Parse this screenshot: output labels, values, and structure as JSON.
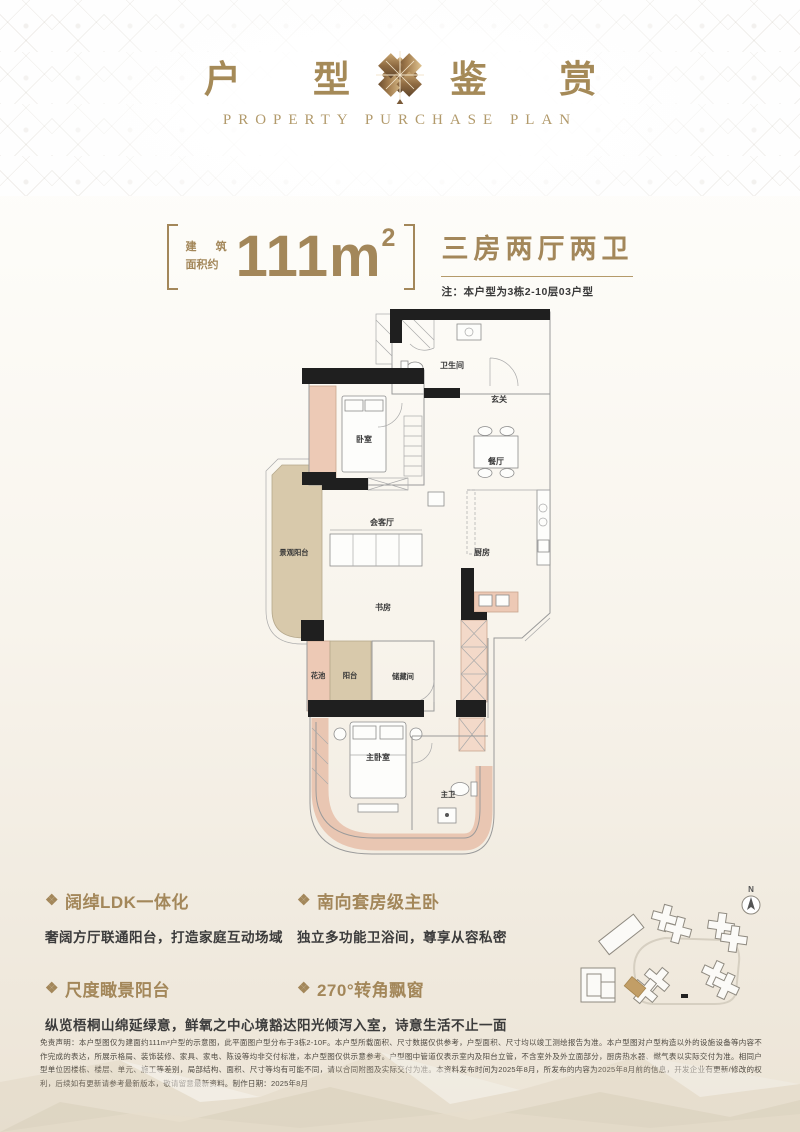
{
  "header": {
    "title_left": "户 型",
    "title_right": "鉴 赏",
    "subtitle": "PROPERTY PURCHASE PLAN"
  },
  "area": {
    "label_line1": "建 筑",
    "label_line2": "面积约",
    "value_number": "111m",
    "value_sup": "2",
    "layout_type": "三房两厅两卫",
    "note": "注：本户型为3栋2-10层03户型"
  },
  "floorplan": {
    "labels": {
      "bathroom": "卫生间",
      "foyer": "玄关",
      "dining": "餐厅",
      "bedroom": "卧室",
      "living": "会客厅",
      "view_balcony": "景观阳台",
      "kitchen": "厨房",
      "study": "书房",
      "flower_bed": "花池",
      "balcony": "阳台",
      "storage": "储藏间",
      "master_bedroom": "主卧室",
      "master_bath": "主卫"
    }
  },
  "features": [
    {
      "icon": "❖",
      "title": "阔绰LDK一体化",
      "desc": "奢阔方厅联通阳台，打造家庭互动场域"
    },
    {
      "icon": "❖",
      "title": "南向套房级主卧",
      "desc": "独立多功能卫浴间，尊享从容私密"
    },
    {
      "icon": "❖",
      "title": "尺度瞰景阳台",
      "desc": "纵览梧桐山绵延绿意，鲜氧之中心境豁达"
    },
    {
      "icon": "❖",
      "title": "270°转角飘窗",
      "desc": "阳光倾泻入室，诗意生活不止一面"
    }
  ],
  "siteplan": {
    "north_label": "N"
  },
  "disclaimer": "免责声明：本户型图仅为建面约111m²户型的示意图，此平面图户型分布于3栋2-10F。本户型所载面积、尺寸数据仅供参考，户型面积、尺寸均以竣工测绘报告为准。本户型图对户型构造以外的设施设备等内容不作完成的表达，所展示格局、装饰装修、家具、家电、陈设等均非交付标准，本户型图仅供示意参考。户型图中管道仅表示室内及阳台立管，不含室外及外立面部分，厨房热水器、燃气表以实际交付为准。相同户型单位因楼栋、楼层、单元、施工等差别，局部结构、面积、尺寸等均有可能不同，请以合同附图及实际交付为准。本资料发布时间为2025年8月，所发布的内容为2025年8月前的信息，开发企业有更新/修改的权利，后续如有更新请参考最新版本，敬请留意最新资料。制作日期：2025年8月",
  "colors": {
    "gold": "#a3875a",
    "dark_text": "#3a3a3a",
    "bay_pink": "#edcab6",
    "balcony_tan": "#d8c9ab",
    "wall_black": "#1f1f1f"
  }
}
